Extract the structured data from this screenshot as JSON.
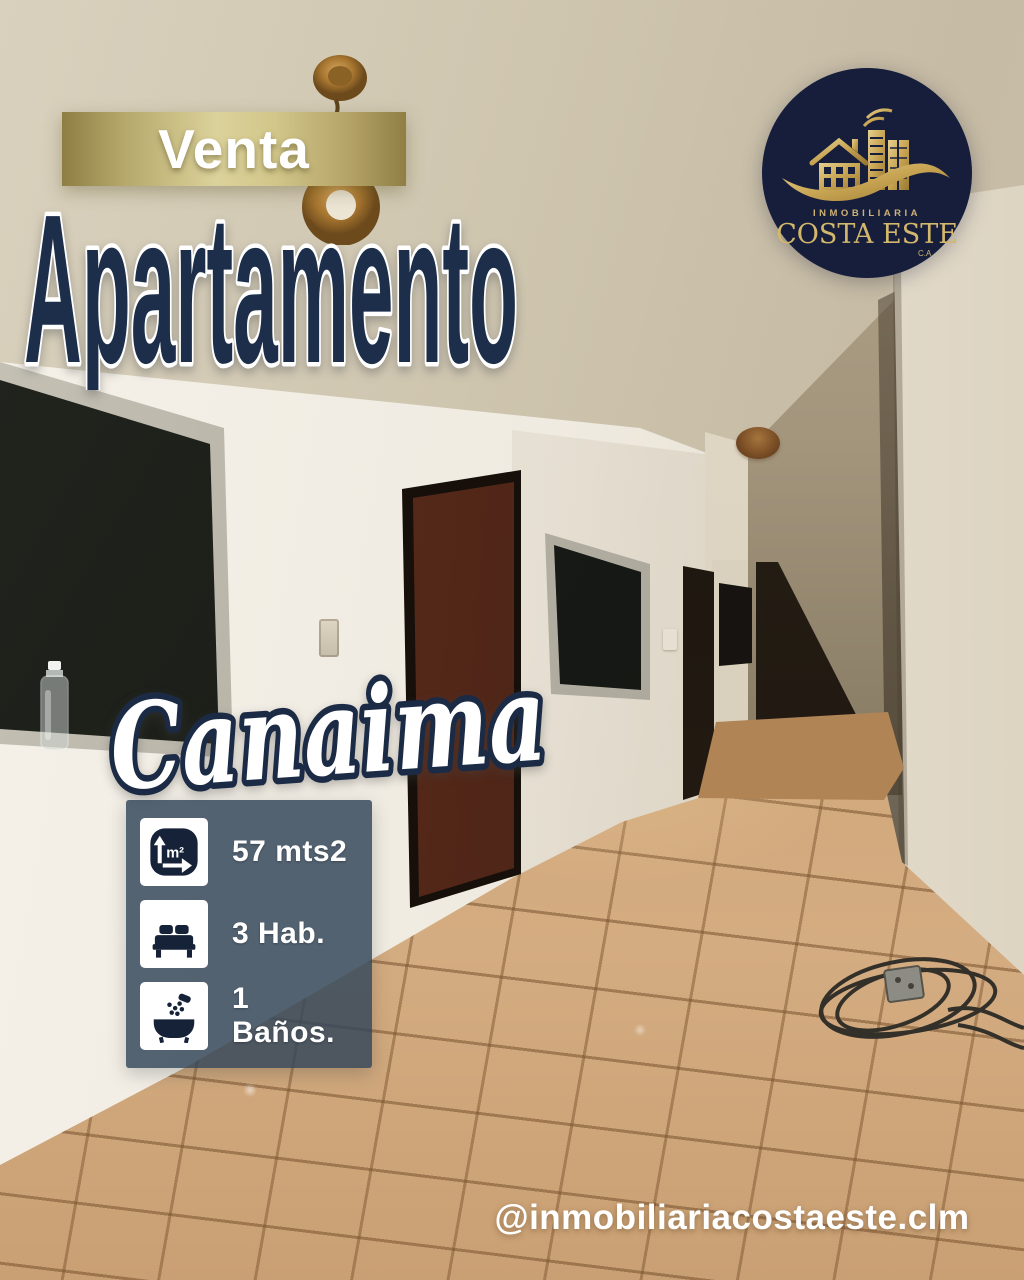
{
  "badge": {
    "label": "Venta"
  },
  "title": "Apartamento",
  "location": "Canaima",
  "logo": {
    "line1": "INMOBILIARIA",
    "line2": "COSTA ESTE",
    "line3": "C.A"
  },
  "features": [
    {
      "icon": "area-icon",
      "label": "57 mts2"
    },
    {
      "icon": "bed-icon",
      "label": "3 Hab."
    },
    {
      "icon": "bath-icon",
      "label": "1 Baños."
    }
  ],
  "social_handle": "@inmobiliariacostaeste.clm",
  "colors": {
    "title_navy": "#1c2e4a",
    "banner_gold": "#d9d099",
    "logo_navy": "#161e3c",
    "logo_gold": "#d3b76c",
    "infobox_slate": "rgba(52,72,90,0.84)",
    "floor_terracotta": "#cfa678",
    "text_white": "#ffffff"
  }
}
